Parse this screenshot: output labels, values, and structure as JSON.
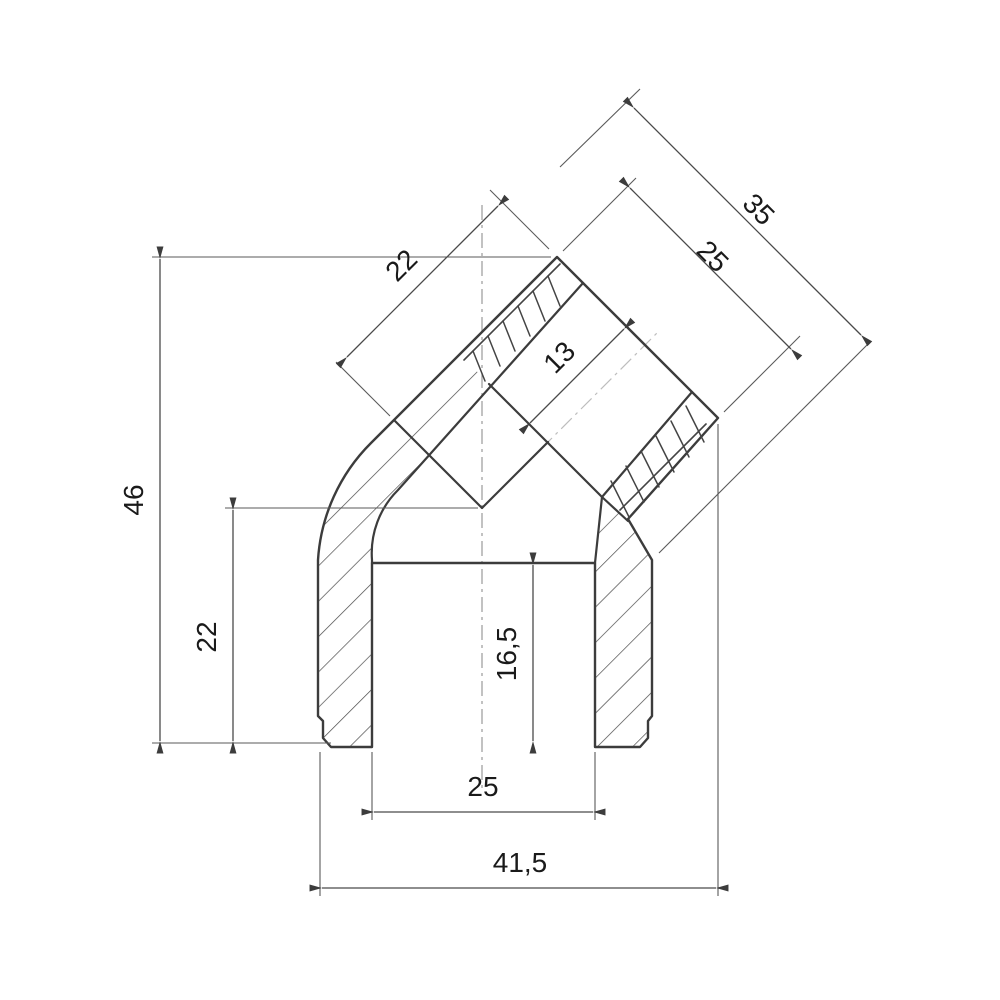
{
  "drawing": {
    "kind": "technical cross-section drawing",
    "subject": "45-degree elbow pipe fitting",
    "background_color": "#ffffff",
    "outline_color": "#3c3c3c",
    "dimension_line_color": "#4a4a4a",
    "centerline_color": "#9a9a9a",
    "text_color": "#1a1a1a"
  },
  "dimensions": {
    "d35": {
      "label": "35",
      "orientation": "diagonal-45",
      "measures": "overall width across angled socket"
    },
    "d25_diag": {
      "label": "25",
      "orientation": "diagonal-45",
      "measures": "angled socket mouth outer diameter"
    },
    "d22_diag": {
      "label": "22",
      "orientation": "diagonal-45",
      "measures": "angled socket depth"
    },
    "d13": {
      "label": "13",
      "orientation": "diagonal-45",
      "measures": "angled socket thread zone depth"
    },
    "d46": {
      "label": "46",
      "orientation": "vertical",
      "measures": "overall height"
    },
    "d22_vert": {
      "label": "22",
      "orientation": "vertical",
      "measures": "height from base to bore shoulder"
    },
    "d16_5": {
      "label": "16,5",
      "orientation": "vertical",
      "measures": "bottom socket depth"
    },
    "d25_bot": {
      "label": "25",
      "orientation": "horizontal",
      "measures": "bottom socket inner diameter"
    },
    "d41_5": {
      "label": "41,5",
      "orientation": "horizontal",
      "measures": "overall width"
    }
  }
}
